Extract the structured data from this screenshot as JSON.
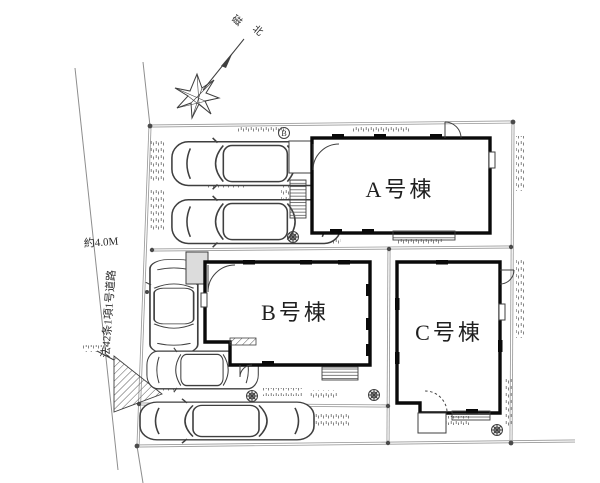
{
  "plan": {
    "type": "residential-site-plan",
    "buildings": [
      {
        "id": "A",
        "label": "A号棟"
      },
      {
        "id": "B",
        "label": "B号棟"
      },
      {
        "id": "C",
        "label": "C号棟"
      }
    ],
    "compass": {
      "char1": "磁",
      "char2": "北"
    },
    "road": {
      "width_label": "約4.0M",
      "law_label": "法42条1項1号道路"
    },
    "survey_marker": {
      "label": "B"
    },
    "colors": {
      "background": "#ffffff",
      "wall": "#0a0a0a",
      "detail_line": "#3f3f3f",
      "boundary_line": "#9a9a9a",
      "label_text": "#1f1f1f"
    }
  }
}
